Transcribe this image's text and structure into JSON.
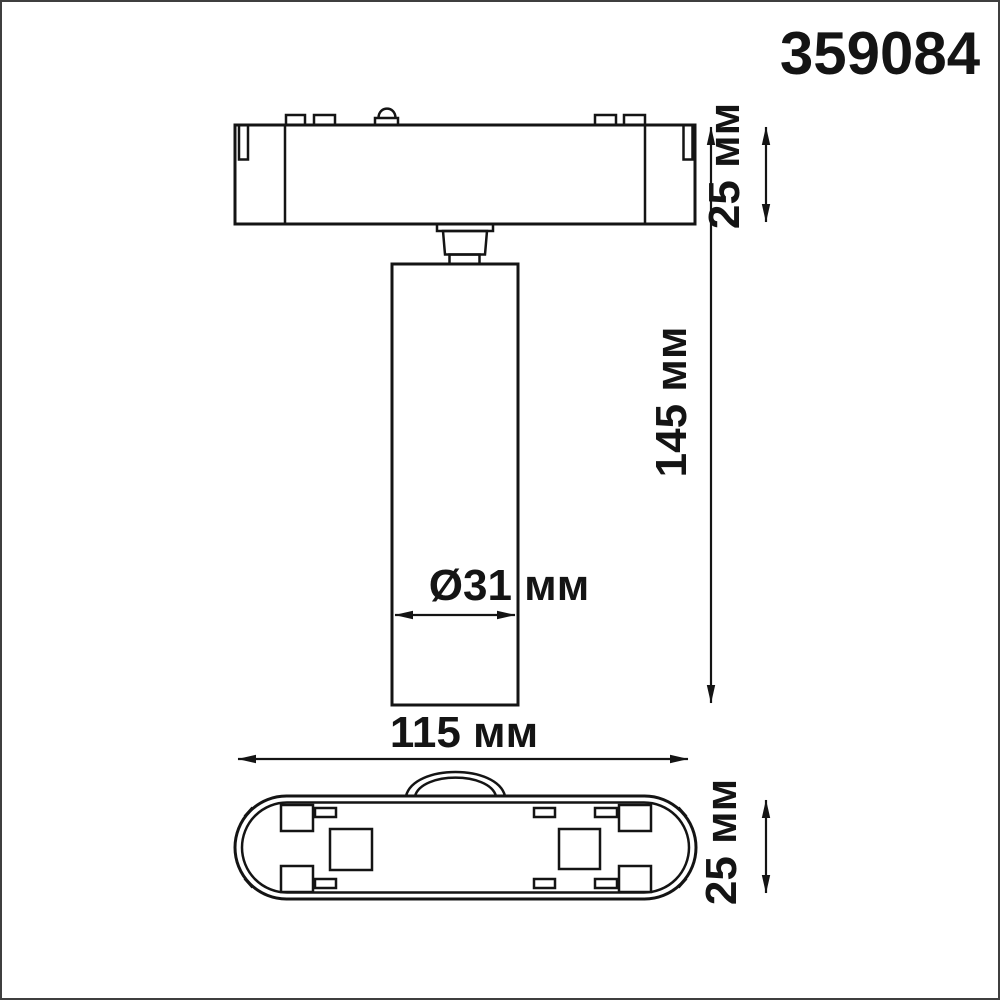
{
  "product_code": "359084",
  "dimension_labels": {
    "mount_height": "25 мм",
    "overall_height": "145 мм",
    "spot_diameter": "Ø31 мм",
    "base_length": "115 мм",
    "base_depth": "25 мм"
  },
  "dimensions_mm": {
    "mount_height": 25,
    "overall_height": 145,
    "spot_diameter": 31,
    "base_length": 115,
    "base_depth": 25
  },
  "colors": {
    "line": "#141414",
    "background": "#ffffff",
    "frame": "#3f3f3f"
  }
}
